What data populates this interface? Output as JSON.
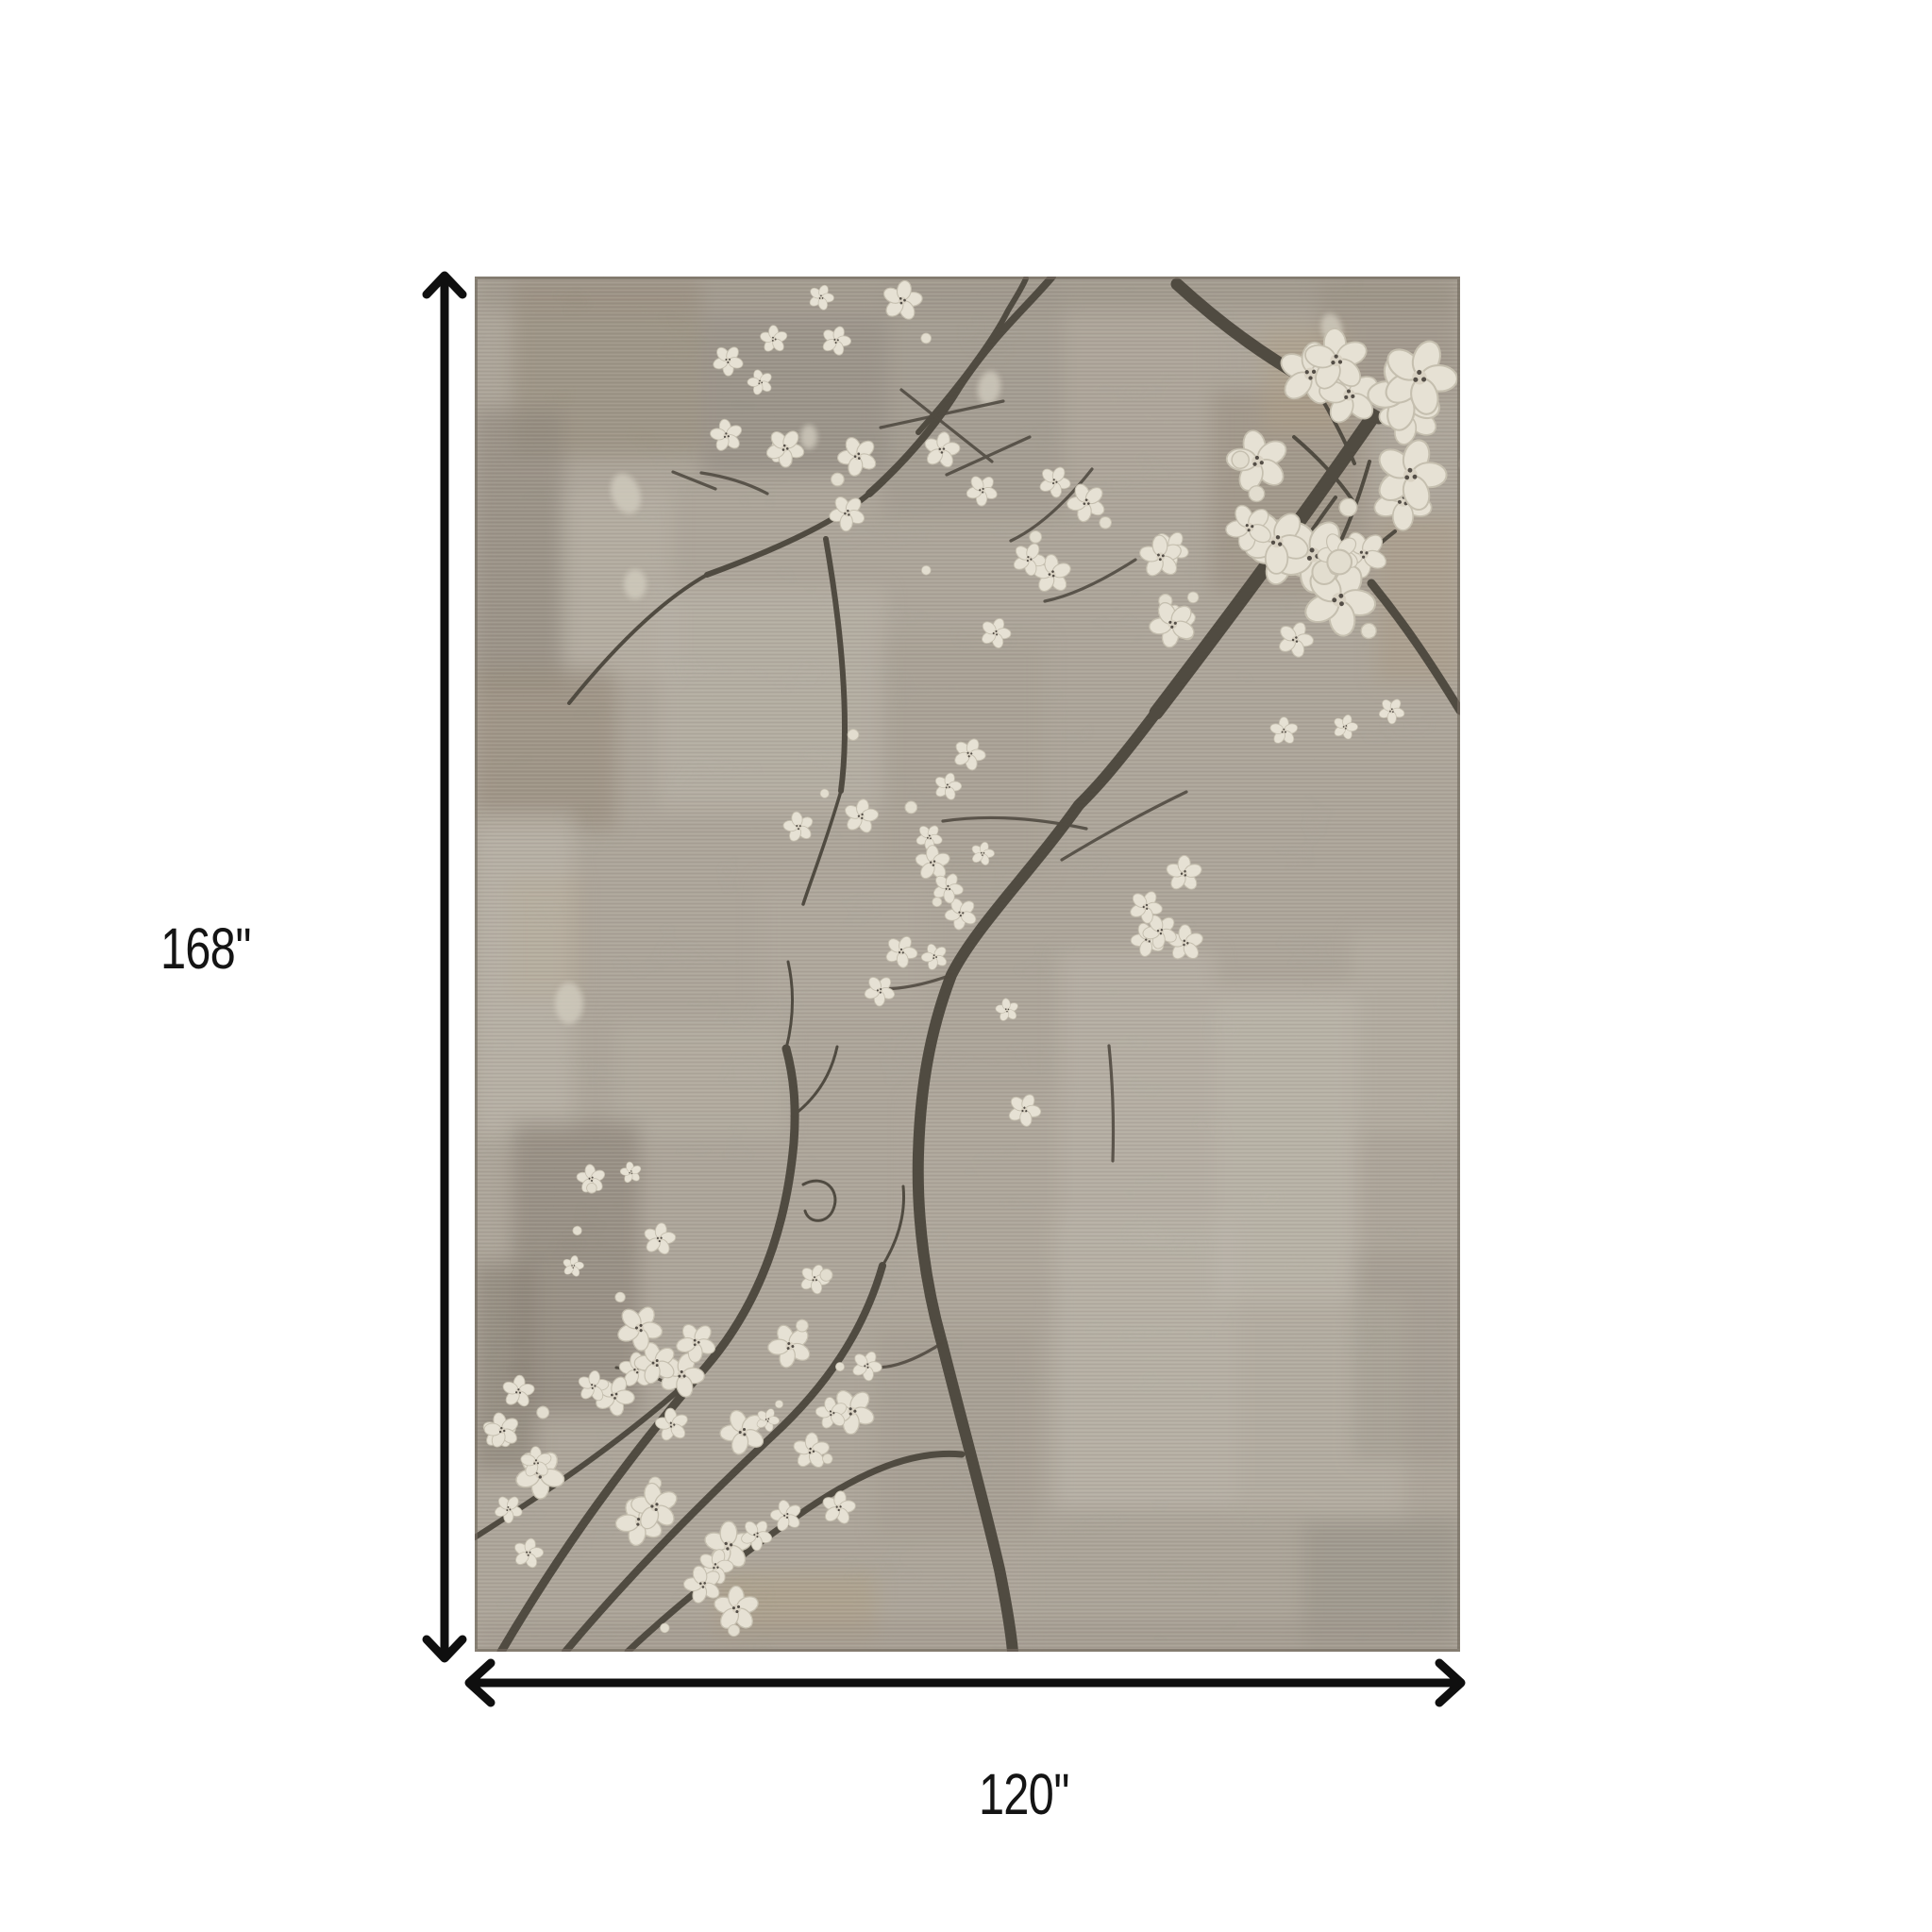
{
  "page": {
    "background_color": "#ffffff",
    "kind": "product dimension image"
  },
  "product": {
    "name": "cherry-blossom-distressed-area-rug",
    "description": "Distressed taupe, beige and gray patchwork area rug with dark charcoal cherry blossom branches and ivory blossom clusters at the top right and bottom left",
    "palette": {
      "rug_base": "#b0a79a",
      "rug_light_patch": "#d0cabf",
      "rug_dark_patch": "#776e61",
      "rug_brown_patch": "#8b7d6a",
      "rug_tan_patch": "#b39a73",
      "branch": "#4a443b",
      "blossom": "#ebe6d9",
      "rug_edge": "#6e665b"
    }
  },
  "dimensions": {
    "height": {
      "label": "168''",
      "value": 168,
      "unit": "inches"
    },
    "width": {
      "label": "120''",
      "value": 120,
      "unit": "inches"
    },
    "arrow_color": "#0f0f0f",
    "text_color": "#141414"
  },
  "icons": {
    "vertical_arrow": "double-headed-vertical-arrow",
    "horizontal_arrow": "double-headed-horizontal-arrow"
  }
}
